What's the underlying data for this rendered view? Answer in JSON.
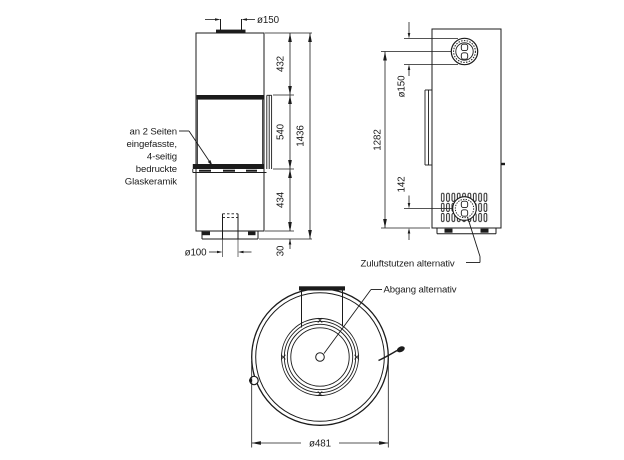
{
  "drawing": {
    "front": {
      "flue_dia": "ø150",
      "top_height": "432",
      "glass_height": "540",
      "total_height": "1436",
      "base_height": "434",
      "plinth_height": "30",
      "air_dia": "ø100",
      "glass_note": {
        "l1": "an 2 Seiten",
        "l2": "eingefasste,",
        "l3": "4-seitig",
        "l4": "bedruckte",
        "l5": "Glaskeramik"
      }
    },
    "side": {
      "flue_dia": "ø150",
      "flue_center_height": "1282",
      "air_center_height": "142",
      "air_label": "Zuluftstutzen alternativ"
    },
    "top_view": {
      "outlet_label": "Abgang alternativ",
      "body_dia": "ø481"
    },
    "colors": {
      "line": "#1b1b1b",
      "background": "#ffffff"
    }
  }
}
